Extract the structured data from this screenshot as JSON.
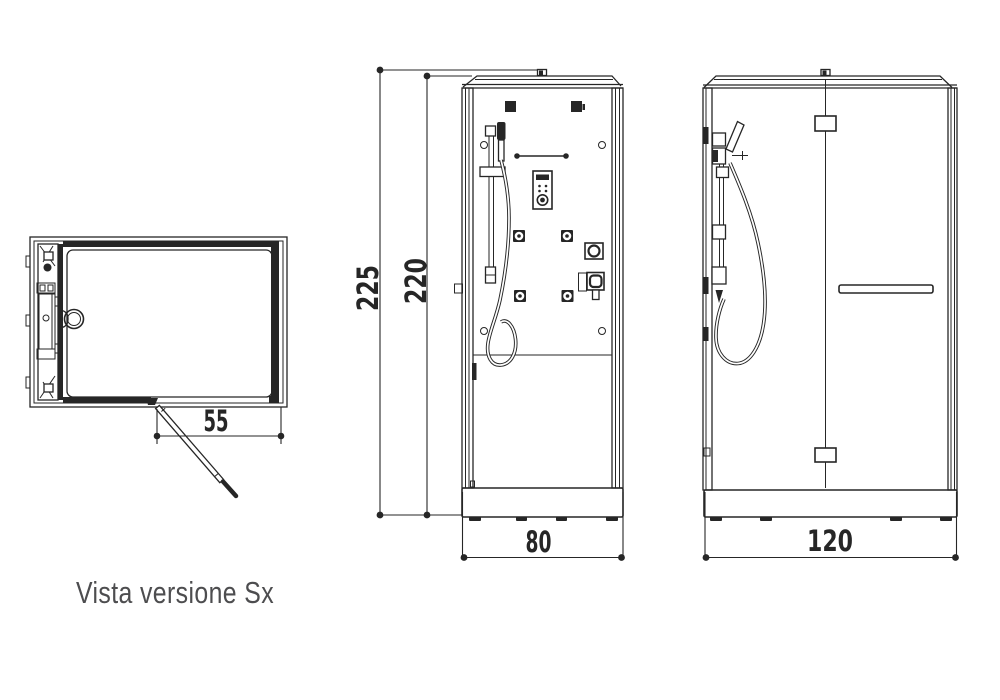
{
  "colors": {
    "line": "#262626",
    "caption": "#4d4d4f",
    "background": "#ffffff"
  },
  "caption": {
    "label": "Vista versione Sx"
  },
  "plan_view": {
    "door_width_dim": "55"
  },
  "front_view": {
    "total_height_dim": "225",
    "cabin_height_dim": "220",
    "width_dim": "80"
  },
  "side_view": {
    "depth_dim": "120"
  }
}
